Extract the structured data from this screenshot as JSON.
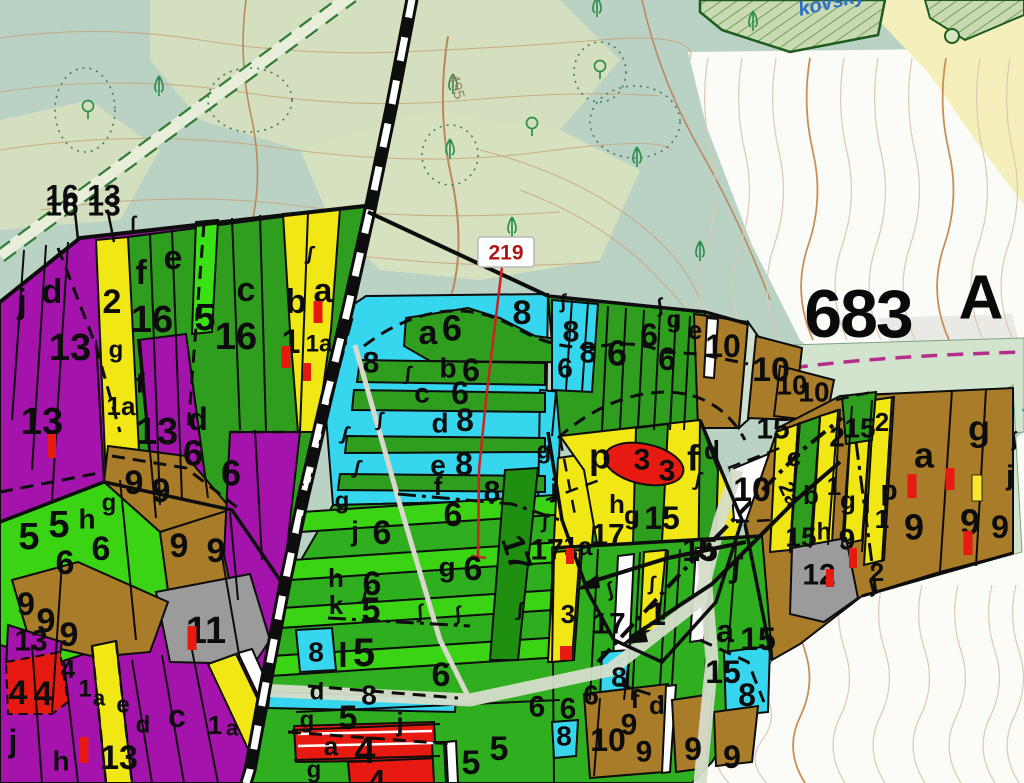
{
  "map": {
    "annotations": {
      "stand_number": "683",
      "stand_letter": "A",
      "waypoint": "219",
      "contour_elevation": "495",
      "stream_name": "kovský",
      "ref_left": "16",
      "ref_right": "13"
    },
    "colors": {
      "forest_green": "#2f9e1f",
      "bright_green": "#3ad415",
      "dark_green_strip": "#1f8f12",
      "cyan": "#36d7ee",
      "yellow": "#f0e714",
      "purple": "#a513ad",
      "brown": "#a87c28",
      "red": "#e61a10",
      "gray": "#9b9b9b",
      "white_parcel": "#ffffff",
      "sage_background": "#b9d2c4",
      "pale_band": "#d2e4ce",
      "field_yellow": "#f5f0bb",
      "magenta_boundary": "#b52f8a",
      "teal_dots": "#3aa0a0",
      "contour": "#c8a47d",
      "waypoint_red": "#b01616",
      "stream_blue": "#2c6fc8",
      "road_black": "#0d0d0d"
    },
    "parcel_labels": [
      [
        "16",
        62,
        206,
        30
      ],
      [
        "13",
        104,
        206,
        30
      ],
      [
        "j",
        22,
        302,
        34
      ],
      [
        "d",
        52,
        292,
        34
      ],
      [
        "13",
        70,
        348,
        38
      ],
      [
        "2",
        112,
        302,
        34
      ],
      [
        "g",
        116,
        350,
        24
      ],
      [
        "f",
        141,
        273,
        34
      ],
      [
        "e",
        173,
        258,
        34
      ],
      [
        "16",
        152,
        320,
        38
      ],
      [
        "5",
        205,
        318,
        38
      ],
      [
        "c",
        246,
        290,
        34
      ],
      [
        "16",
        236,
        337,
        38
      ],
      [
        "b",
        296,
        302,
        34
      ],
      [
        "a",
        323,
        291,
        34
      ],
      [
        "1",
        291,
        342,
        34
      ],
      [
        "1a",
        319,
        344,
        24
      ],
      [
        "13",
        42,
        422,
        38
      ],
      [
        "f",
        140,
        383,
        28
      ],
      [
        "1a",
        121,
        406,
        26
      ],
      [
        "13",
        157,
        432,
        38
      ],
      [
        "d",
        198,
        419,
        32
      ],
      [
        "6",
        193,
        453,
        36
      ],
      [
        "6",
        231,
        473,
        36
      ],
      [
        "g",
        109,
        503,
        24
      ],
      [
        "9",
        134,
        483,
        34
      ],
      [
        "9",
        161,
        491,
        34
      ],
      [
        "5",
        29,
        537,
        38
      ],
      [
        "5",
        59,
        525,
        38
      ],
      [
        "h",
        87,
        519,
        28
      ],
      [
        "6",
        101,
        549,
        34
      ],
      [
        "6",
        65,
        563,
        34
      ],
      [
        "9",
        179,
        546,
        34
      ],
      [
        "9",
        216,
        551,
        34
      ],
      [
        "9",
        26,
        604,
        32
      ],
      [
        "9",
        46,
        621,
        34
      ],
      [
        "9",
        69,
        635,
        34
      ],
      [
        "13",
        31,
        641,
        30
      ],
      [
        "4",
        18,
        693,
        34
      ],
      [
        "4",
        43,
        694,
        34
      ],
      [
        "4",
        68,
        669,
        26
      ],
      [
        "11",
        206,
        631,
        38
      ],
      [
        "1",
        85,
        689,
        24
      ],
      [
        "a",
        99,
        698,
        22
      ],
      [
        "e",
        123,
        705,
        24
      ],
      [
        "d",
        143,
        725,
        24
      ],
      [
        "c",
        177,
        716,
        32
      ],
      [
        "13",
        119,
        758,
        34
      ],
      [
        "j",
        13,
        741,
        32
      ],
      [
        "h",
        61,
        761,
        28
      ],
      [
        "1",
        215,
        725,
        26
      ],
      [
        "a",
        232,
        728,
        22
      ],
      [
        "8",
        522,
        313,
        34
      ],
      [
        "a",
        428,
        333,
        34
      ],
      [
        "6",
        452,
        328,
        36
      ],
      [
        "8",
        371,
        363,
        30
      ],
      [
        "b",
        448,
        368,
        28
      ],
      [
        "6",
        471,
        370,
        32
      ],
      [
        "c",
        422,
        393,
        28
      ],
      [
        "6",
        460,
        393,
        32
      ],
      [
        "d",
        440,
        423,
        28
      ],
      [
        "8",
        465,
        420,
        32
      ],
      [
        "e",
        438,
        465,
        28
      ],
      [
        "8",
        464,
        464,
        32
      ],
      [
        "f",
        438,
        486,
        26
      ],
      [
        "8",
        492,
        492,
        30
      ],
      [
        "g",
        342,
        501,
        24
      ],
      [
        "j",
        355,
        531,
        28
      ],
      [
        "6",
        382,
        533,
        34
      ],
      [
        "6",
        453,
        515,
        34
      ],
      [
        "g",
        447,
        567,
        28
      ],
      [
        "6",
        473,
        569,
        34
      ],
      [
        "h",
        336,
        578,
        26
      ],
      [
        "6",
        372,
        584,
        34
      ],
      [
        "k",
        336,
        605,
        26
      ],
      [
        "5",
        371,
        610,
        34
      ],
      [
        "8",
        316,
        652,
        28
      ],
      [
        "l",
        343,
        656,
        34
      ],
      [
        "5",
        364,
        653,
        40
      ],
      [
        "6",
        441,
        675,
        34
      ],
      [
        "d",
        317,
        692,
        24
      ],
      [
        "8",
        369,
        695,
        28
      ],
      [
        "g",
        307,
        720,
        24
      ],
      [
        "5",
        348,
        718,
        34
      ],
      [
        "j",
        400,
        722,
        26
      ],
      [
        "a",
        331,
        746,
        26
      ],
      [
        "4",
        365,
        751,
        38
      ],
      [
        "g",
        314,
        770,
        24
      ],
      [
        "4",
        377,
        781,
        30
      ],
      [
        "5",
        471,
        763,
        34
      ],
      [
        "5",
        499,
        749,
        34
      ],
      [
        "17",
        517,
        553,
        32,
        72
      ],
      [
        "j",
        554,
        488,
        26
      ],
      [
        "17",
        547,
        550,
        30
      ],
      [
        "1a",
        578,
        546,
        26
      ],
      [
        "h",
        617,
        504,
        26
      ],
      [
        "g",
        632,
        515,
        26
      ],
      [
        "17",
        608,
        535,
        30
      ],
      [
        "15",
        662,
        518,
        32
      ],
      [
        "15",
        700,
        550,
        32
      ],
      [
        "10",
        752,
        490,
        34
      ],
      [
        "8",
        571,
        332,
        30
      ],
      [
        "8",
        588,
        353,
        30
      ],
      [
        "6",
        565,
        368,
        28
      ],
      [
        "6",
        617,
        353,
        36
      ],
      [
        "6",
        649,
        335,
        32
      ],
      [
        "6",
        667,
        359,
        32
      ],
      [
        "g",
        674,
        320,
        24
      ],
      [
        "e",
        695,
        330,
        26
      ],
      [
        "10",
        723,
        346,
        32
      ],
      [
        "10",
        771,
        370,
        34
      ],
      [
        "10",
        792,
        385,
        28
      ],
      [
        "10",
        814,
        392,
        28
      ],
      [
        "p",
        600,
        456,
        36
      ],
      [
        "3",
        642,
        460,
        30
      ],
      [
        "3",
        667,
        471,
        30
      ],
      [
        "f",
        693,
        458,
        36
      ],
      [
        "d",
        712,
        450,
        26
      ],
      [
        "g",
        544,
        451,
        24
      ],
      [
        "5",
        707,
        549,
        32
      ],
      [
        "15",
        773,
        429,
        30
      ],
      [
        "2",
        837,
        437,
        28
      ],
      [
        "c",
        794,
        457,
        26
      ],
      [
        "2a",
        790,
        494,
        22,
        65
      ],
      [
        "b",
        811,
        495,
        26
      ],
      [
        "1",
        834,
        486,
        26
      ],
      [
        "g",
        848,
        500,
        26
      ],
      [
        "l",
        867,
        504,
        26
      ],
      [
        "p",
        889,
        490,
        28
      ],
      [
        "15",
        801,
        537,
        28
      ],
      [
        "h",
        824,
        532,
        24
      ],
      [
        "9",
        847,
        540,
        30
      ],
      [
        "12",
        819,
        575,
        30
      ],
      [
        "1",
        882,
        519,
        26
      ],
      [
        "2",
        877,
        572,
        26
      ],
      [
        "15",
        860,
        428,
        28
      ],
      [
        "2",
        882,
        422,
        26
      ],
      [
        "a",
        924,
        455,
        36
      ],
      [
        "9",
        914,
        527,
        36
      ],
      [
        "g",
        979,
        428,
        36
      ],
      [
        "j",
        1010,
        475,
        28
      ],
      [
        "9",
        970,
        522,
        36
      ],
      [
        "9",
        1000,
        527,
        32
      ],
      [
        "3",
        568,
        614,
        26
      ],
      [
        "17",
        609,
        624,
        30
      ],
      [
        "1",
        657,
        614,
        32
      ],
      [
        "a",
        725,
        631,
        32
      ],
      [
        "15",
        758,
        639,
        32
      ],
      [
        "15",
        723,
        672,
        32
      ],
      [
        "8",
        747,
        695,
        32
      ],
      [
        "8",
        619,
        677,
        28
      ],
      [
        "f",
        635,
        699,
        26
      ],
      [
        "d",
        657,
        705,
        26
      ],
      [
        "6",
        537,
        707,
        30
      ],
      [
        "6",
        568,
        709,
        30
      ],
      [
        "6",
        591,
        695,
        28
      ],
      [
        "8",
        564,
        736,
        28
      ],
      [
        "10",
        608,
        740,
        32
      ],
      [
        "9",
        629,
        725,
        30
      ],
      [
        "9",
        644,
        752,
        30
      ],
      [
        "9",
        693,
        749,
        32
      ],
      [
        "9",
        732,
        757,
        32
      ]
    ],
    "markers": {
      "red": [
        [
          318,
          312,
          9,
          22
        ],
        [
          286,
          357,
          9,
          22
        ],
        [
          307,
          372,
          8,
          18
        ],
        [
          52,
          446,
          8,
          24
        ],
        [
          192,
          638,
          9,
          24
        ],
        [
          84,
          750,
          9,
          26
        ],
        [
          570,
          556,
          8,
          16
        ],
        [
          566,
          653,
          12,
          14
        ],
        [
          912,
          486,
          9,
          24
        ],
        [
          950,
          479,
          9,
          22
        ],
        [
          968,
          543,
          9,
          24
        ],
        [
          853,
          558,
          8,
          20
        ],
        [
          830,
          578,
          8,
          18
        ]
      ],
      "yellow": [
        [
          977,
          488,
          10,
          26
        ]
      ]
    },
    "trees": {
      "conifer": [
        [
          159,
          87
        ],
        [
          453,
          85
        ],
        [
          450,
          150
        ],
        [
          512,
          228
        ],
        [
          597,
          8
        ],
        [
          753,
          22
        ],
        [
          637,
          158
        ],
        [
          700,
          252
        ]
      ],
      "deciduous": [
        [
          88,
          110
        ],
        [
          532,
          127
        ],
        [
          600,
          70
        ]
      ]
    }
  }
}
